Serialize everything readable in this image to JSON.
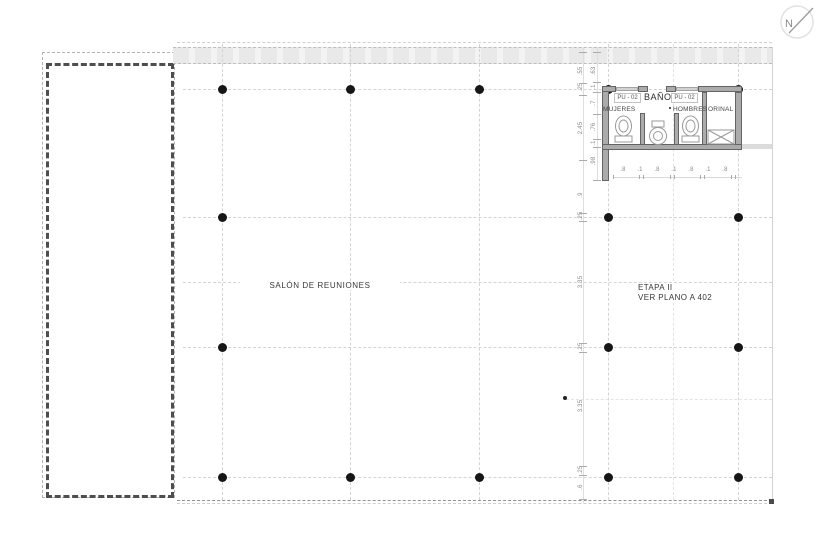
{
  "north_arrow": {
    "label": "N"
  },
  "plan": {
    "salon_label": "SALÓN DE REUNIONES",
    "etapa_line1": "ETAPA II",
    "etapa_line2": "VER PLANO A 402"
  },
  "bathroom": {
    "title": "BAÑO",
    "door_tag_left": "PU - 02",
    "door_tag_right": "PU - 02",
    "room_left": "MUJERES",
    "room_center": "HOMBRES",
    "room_right": "ORINAL"
  },
  "columns": {
    "dots": [
      [
        222,
        89
      ],
      [
        350,
        89
      ],
      [
        479,
        89
      ],
      [
        608,
        89
      ],
      [
        738,
        89
      ],
      [
        222,
        217
      ],
      [
        608,
        217
      ],
      [
        738,
        217
      ],
      [
        222,
        347
      ],
      [
        608,
        347
      ],
      [
        738,
        347
      ],
      [
        222,
        477
      ],
      [
        350,
        477
      ],
      [
        479,
        477
      ],
      [
        608,
        477
      ],
      [
        738,
        477
      ]
    ]
  },
  "dimensions": {
    "chain_outer": [
      {
        "t": ".55",
        "y": 71
      },
      {
        "t": ".25",
        "y": 87
      },
      {
        "t": "2.45",
        "y": 128
      },
      {
        "t": ".9",
        "y": 195
      },
      {
        "t": ".25",
        "y": 216
      },
      {
        "t": "3.35",
        "y": 282
      },
      {
        "t": ".25",
        "y": 347
      },
      {
        "t": "3.35",
        "y": 406
      },
      {
        "t": ".25",
        "y": 470
      },
      {
        "t": ".6",
        "y": 487
      }
    ],
    "chain_outer_ticks": [
      52,
      83,
      95,
      160,
      213,
      221,
      343,
      352,
      466,
      475,
      499
    ],
    "chain_inner": [
      {
        "t": ".63",
        "y": 71
      },
      {
        "t": ".1",
        "y": 87
      },
      {
        "t": ".7",
        "y": 103
      },
      {
        "t": ".76",
        "y": 127
      },
      {
        "t": ".1",
        "y": 143
      },
      {
        "t": ".98",
        "y": 161
      }
    ],
    "chain_inner_ticks": [
      52,
      82,
      92,
      114,
      139,
      147,
      180
    ],
    "bottom_row": [
      {
        "t": ".8",
        "x": 623
      },
      {
        "t": ".1",
        "x": 640
      },
      {
        "t": ".8",
        "x": 657
      },
      {
        "t": ".1",
        "x": 674
      },
      {
        "t": ".8",
        "x": 691
      },
      {
        "t": ".1",
        "x": 708
      },
      {
        "t": ".8",
        "x": 725
      }
    ],
    "bottom_ticks": [
      613,
      639,
      643,
      670,
      674,
      700,
      704,
      731,
      735
    ]
  },
  "colors": {
    "wall_fill": "#ababab",
    "wall_edge": "#646464",
    "grid": "#d4d4d4",
    "dim_text": "#8b8b8b",
    "label_text": "#3a3a3a",
    "column_dot": "#161616",
    "top_band": "#eaeaea",
    "dashed_dark": "#4e4e4e",
    "dashed_light": "#b3b3b3"
  }
}
